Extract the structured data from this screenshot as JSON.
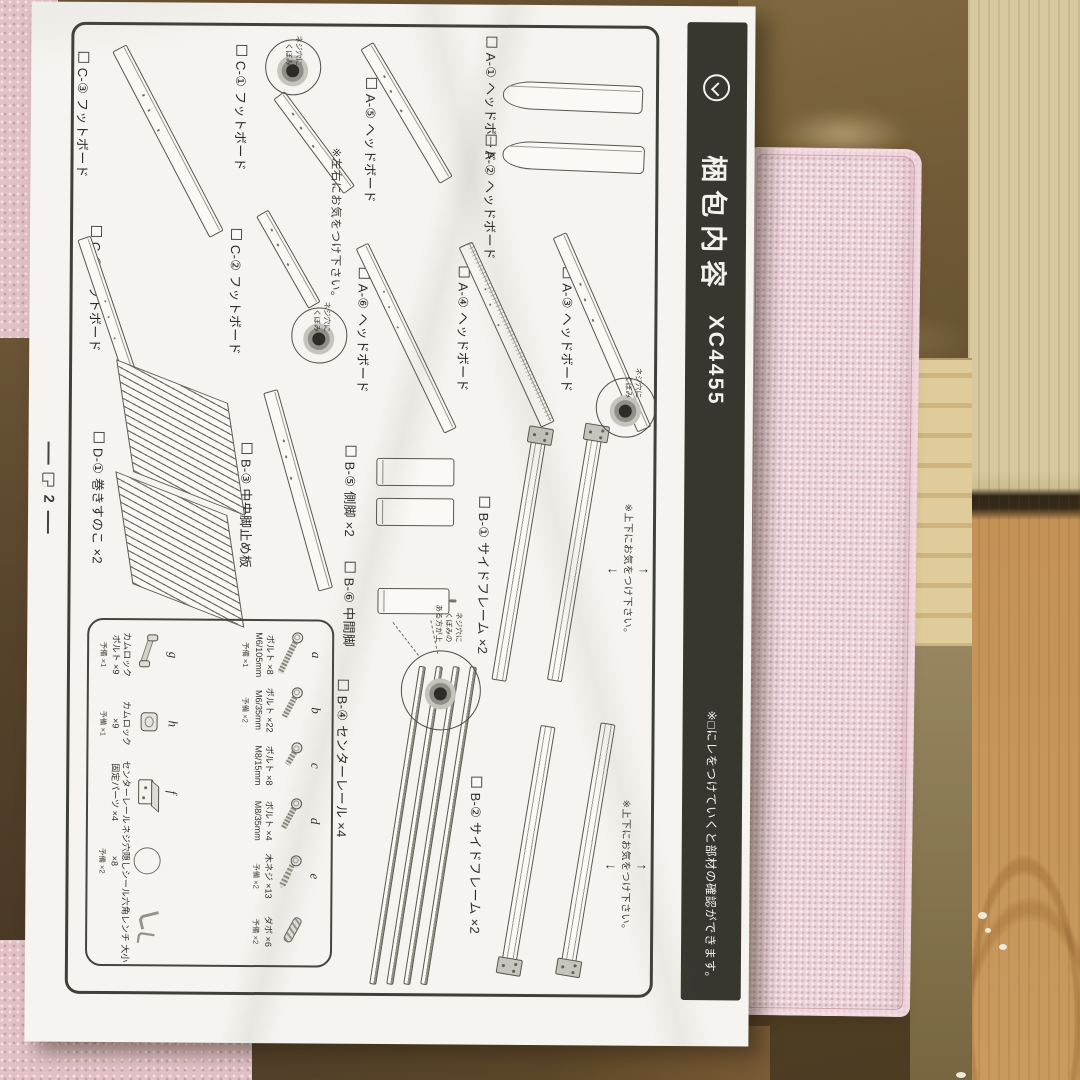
{
  "title_bar": {
    "icon": "circle-chevron-icon",
    "title": "梱包内容",
    "model": "XC4455",
    "note": "※□にレをつけていくと部材の確認ができます。"
  },
  "page": {
    "number": "2"
  },
  "notes": {
    "left_right": {
      "text": "※左右にお気をつけ下さい。",
      "x": 142,
      "y": 404
    },
    "up_down": [
      {
        "text": "※上下にお気をつけ下さい。",
        "x": 496,
        "y": 94,
        "arrow_up": "↑",
        "arrow_down": "↓"
      },
      {
        "text": "※上下にお気をつけ下さい。",
        "x": 792,
        "y": 94,
        "arrow_up": "↑",
        "arrow_down": "↓"
      }
    ]
  },
  "callouts": [
    {
      "key": "screw-hole-1",
      "cx": 62,
      "cy": 456,
      "r": 28,
      "tx": 30,
      "ty": 446,
      "text": "ネジ穴に\nくぼみ"
    },
    {
      "key": "screw-hole-2",
      "cx": 330,
      "cy": 428,
      "r": 28,
      "tx": 296,
      "ty": 416,
      "text": "ネジ穴に\nくぼみ"
    },
    {
      "key": "screw-hole-3",
      "cx": 400,
      "cy": 121,
      "r": 30,
      "tx": 360,
      "ty": 104,
      "text": "ネジ穴に\nくぼみ"
    },
    {
      "key": "screw-hole-4",
      "cx": 684,
      "cy": 304,
      "r": 40,
      "tx": 598,
      "ty": 282,
      "text": "ネジ穴に\nくぼみの\nある方が上",
      "dashes": [
        {
          "x": 614,
          "y": 314,
          "len": 34,
          "rot": -12
        },
        {
          "x": 616,
          "y": 352,
          "len": 42,
          "rot": -38
        }
      ]
    }
  ],
  "parts": [
    {
      "key": "a1",
      "label": "A-① ヘッドボード",
      "lx": 30,
      "ly": 248,
      "shape": {
        "type": "panel",
        "x": 76,
        "y": 106,
        "w": 28,
        "h": 140,
        "rot": 2
      }
    },
    {
      "key": "a2",
      "label": "A-② ヘッドボード",
      "lx": 128,
      "ly": 248,
      "shape": {
        "type": "panel",
        "x": 136,
        "y": 104,
        "w": 28,
        "h": 142,
        "rot": 2
      }
    },
    {
      "key": "a3",
      "label": "A-③ ヘッドボード",
      "lx": 260,
      "ly": 170,
      "shape": {
        "type": "board",
        "x": 228,
        "y": 188,
        "len": 212,
        "th": 15,
        "rot": -24
      }
    },
    {
      "key": "a4",
      "label": "A-④ ヘッドボード",
      "lx": 260,
      "ly": 274,
      "shape": {
        "type": "board",
        "x": 238,
        "y": 282,
        "len": 198,
        "th": 15,
        "rot": -25,
        "hatch": true
      }
    },
    {
      "key": "a5",
      "label": "A-⑤ ヘッドボード",
      "lx": 72,
      "ly": 368,
      "shape": {
        "type": "board",
        "x": 40,
        "y": 382,
        "len": 156,
        "th": 15,
        "rot": -31
      }
    },
    {
      "key": "a6",
      "label": "A-⑥ ヘッドボード",
      "lx": 262,
      "ly": 374,
      "shape": {
        "type": "board",
        "x": 240,
        "y": 386,
        "len": 205,
        "th": 14,
        "rot": -26
      }
    },
    {
      "key": "c1",
      "label": "C-① フットボード",
      "lx": 40,
      "ly": 498,
      "shape": {
        "type": "board",
        "x": 90,
        "y": 470,
        "len": 118,
        "th": 14,
        "rot": -37
      }
    },
    {
      "key": "c2",
      "label": "C-② フットボード",
      "lx": 224,
      "ly": 502,
      "shape": {
        "type": "board",
        "x": 208,
        "y": 486,
        "len": 106,
        "th": 14,
        "rot": -30
      }
    },
    {
      "key": "c3",
      "label": "C-③ フットボード",
      "lx": 48,
      "ly": 656,
      "shape": {
        "type": "board",
        "x": 44,
        "y": 630,
        "len": 210,
        "th": 16,
        "rot": -28
      }
    },
    {
      "key": "c4",
      "label": "C-④ フットボード",
      "lx": 222,
      "ly": 642,
      "shape": {
        "type": "board",
        "x": 234,
        "y": 664,
        "len": 254,
        "th": 14,
        "rot": -19
      }
    },
    {
      "key": "b3",
      "label": "B-③ 中央脚止め板",
      "lx": 438,
      "ly": 490,
      "shape": {
        "type": "board",
        "x": 386,
        "y": 476,
        "len": 206,
        "th": 15,
        "rot": -16
      }
    },
    {
      "key": "d1",
      "label": "D-① 巻きすのこ ×2",
      "lx": 428,
      "ly": 638,
      "shape": {
        "type": "slats",
        "x": 376,
        "y": 514
      }
    },
    {
      "key": "b5",
      "label": "B-⑤ 側脚 ×2",
      "lx": 440,
      "ly": 386,
      "shape": {
        "type": "legs2",
        "x": 452,
        "y": 292,
        "w": 28,
        "h": 78,
        "gap": 12
      }
    },
    {
      "key": "b6",
      "label": "B-⑥ 中間脚",
      "lx": 556,
      "ly": 386,
      "shape": {
        "type": "leg",
        "x": 582,
        "y": 296,
        "w": 26,
        "h": 72,
        "pin": true
      }
    },
    {
      "key": "b1",
      "label": "B-① サイドフレーム ×2",
      "lx": 490,
      "ly": 252,
      "shape": {
        "type": "frames",
        "rot": 9,
        "bracket": "left",
        "bars": [
          {
            "x": 421,
            "y": 150,
            "len": 256
          },
          {
            "x": 424,
            "y": 206,
            "len": 253
          }
        ]
      }
    },
    {
      "key": "b2",
      "label": "B-② サイドフレーム ×2",
      "lx": 770,
      "ly": 258,
      "shape": {
        "type": "frames",
        "rot": 9,
        "bracket": "right",
        "bars": [
          {
            "x": 716,
            "y": 136,
            "len": 252
          },
          {
            "x": 719,
            "y": 196,
            "len": 248
          }
        ]
      }
    },
    {
      "key": "b4",
      "label": "B-④ センターレール ×4",
      "lx": 674,
      "ly": 392,
      "shape": {
        "type": "rails",
        "x": 660,
        "ys": [
          268,
          285,
          302,
          319
        ],
        "len": 322,
        "rot": 8.5
      }
    }
  ],
  "hardware": {
    "rows": [
      [
        {
          "letter": "a",
          "icon": "bolt-long",
          "lines": [
            "ボルト ×8",
            "M6/105mm"
          ],
          "spare": "予備 ×1"
        },
        {
          "letter": "b",
          "icon": "bolt-mid",
          "lines": [
            "ボルト ×22",
            "M6/35mm"
          ],
          "spare": "予備 ×2"
        },
        {
          "letter": "c",
          "icon": "bolt-short",
          "lines": [
            "ボルト ×8",
            "M8/15mm"
          ],
          "spare": ""
        },
        {
          "letter": "d",
          "icon": "bolt-mid2",
          "lines": [
            "ボルト ×4",
            "M8/35mm"
          ],
          "spare": ""
        },
        {
          "letter": "e",
          "icon": "wood-screw",
          "lines": [
            "木ネジ ×13"
          ],
          "spare": "予備 ×2"
        },
        {
          "letter": "",
          "icon": "dowel",
          "lines": [
            "ダボ ×6"
          ],
          "spare": "予備 ×2"
        }
      ],
      [
        {
          "letter": "g",
          "icon": "camlock-bolt",
          "lines": [
            "カムロック",
            "ボルト ×9"
          ],
          "spare": "予備 ×1"
        },
        {
          "letter": "h",
          "icon": "camlock",
          "lines": [
            "カムロック",
            "×9"
          ],
          "spare": "予備 ×1"
        },
        {
          "letter": "f",
          "icon": "fixing-block",
          "lines": [
            "センターレール",
            "固定パーツ ×4"
          ],
          "spare": ""
        },
        {
          "letter": "",
          "icon": "screw-hole-sticker",
          "lines": [
            "ネジ穴隠しシール",
            "×8"
          ],
          "spare": "予備 ×2"
        },
        {
          "letter": "",
          "icon": "hex-wrench",
          "lines": [
            "六角レンチ 大小"
          ],
          "spare": ""
        }
      ]
    ]
  },
  "scene": {
    "paper_color": "#f5f4f0",
    "titlebar_color": "#37362f",
    "fabric_pink": "#ecd3da",
    "carpet_pink": "#e2c2c7",
    "wood_light": "#d8c89e",
    "wood_orange": "#c49257",
    "wood_dark": "#5d4a2b"
  }
}
